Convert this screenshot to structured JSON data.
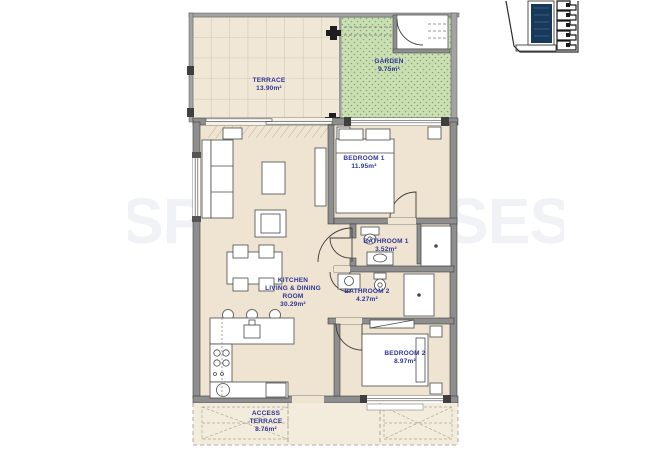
{
  "document": {
    "type": "apartment floor plan",
    "watermark": "SPAINHOUSES"
  },
  "plan": {
    "rooms": [
      {
        "id": "terrace",
        "name_lines": [
          "TERRACE"
        ],
        "area": "13.90m²"
      },
      {
        "id": "garden",
        "name_lines": [
          "GARDEN"
        ],
        "area": "9.75m²"
      },
      {
        "id": "bedroom-1",
        "name_lines": [
          "BEDROOM  1"
        ],
        "area": "11.95m²"
      },
      {
        "id": "bathroom-1",
        "name_lines": [
          "BATHROOM  1"
        ],
        "area": "3.52m²"
      },
      {
        "id": "bathroom-2",
        "name_lines": [
          "BATHROOM  2"
        ],
        "area": "4.27m²"
      },
      {
        "id": "kitchen-living-dining",
        "name_lines": [
          "KITCHEN",
          "LIVING  &  DINING",
          "ROOM"
        ],
        "area": "30.29m²"
      },
      {
        "id": "bedroom-2",
        "name_lines": [
          "BEDROOM  2"
        ],
        "area": "8.97m²"
      },
      {
        "id": "access-terrace",
        "name_lines": [
          "ACCESS",
          "TERRACE"
        ],
        "area": "8.76m²"
      }
    ],
    "colors": {
      "floor": "#efe3d2",
      "terrace_floor": "#f1e7d6",
      "garden": "#cbdfb4",
      "garden_dots": "#84a765",
      "walls": "#8e8e8e",
      "label_text": "#2c3594",
      "inset_highlight": "#17395c"
    }
  }
}
